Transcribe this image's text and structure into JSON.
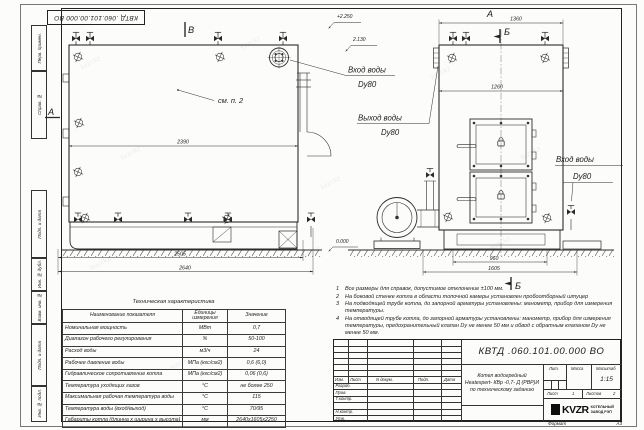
{
  "watermark": "kvzr.kz",
  "stamp_top": "КВТД .060.101.00.000 ВО",
  "margin_boxes": [
    "Перв. примен.",
    "Справ. №",
    "Подп. и дата",
    "Инв. № дубл.",
    "Взам. инв. №",
    "Подп. и дата",
    "Инв. № подл."
  ],
  "drawing": {
    "side_view": {
      "view_label_top": "В",
      "view_label_left": "А",
      "see_note": "см. п. 2",
      "dim_body": "2390",
      "dim_base": "2505",
      "dim_overall": "2640",
      "elev_top": "+2.250",
      "elev_stack": "2.130",
      "elev_zero": "0.000",
      "label_inlet": "Вход воды",
      "label_inlet_dn": "Dу80",
      "label_outlet": "Выход воды",
      "label_outlet_dn": "Dу80"
    },
    "front_view": {
      "view_label": "А",
      "dim_top": "1360",
      "dim_shell": "1260",
      "dim_base": "960",
      "dim_overall": "1605",
      "section_mark_top": "Б",
      "section_mark_bottom": "Б",
      "label_inlet": "Вход воды",
      "label_inlet_dn": "Dу80"
    }
  },
  "tech_table": {
    "title": "Техническая характеристика",
    "headers": [
      "Наименование показателя",
      "Единицы измерения",
      "Значение"
    ],
    "rows": [
      [
        "Номинальная мощность",
        "МВт",
        "0,7"
      ],
      [
        "Диапазон рабочего регулирования",
        "%",
        "50-100"
      ],
      [
        "Расход воды",
        "м3/ч",
        "24"
      ],
      [
        "Рабочее давление воды",
        "МПа (кгс/см2)",
        "0,6 (6,0)"
      ],
      [
        "Гидравлическое сопротивление котла",
        "МПа (кгс/см2)",
        "0,06 (0,6)"
      ],
      [
        "Температура уходящих газов",
        "°С",
        "не более 250"
      ],
      [
        "Максимальная рабочая температура воды",
        "°С",
        "115"
      ],
      [
        "Температура воды (вход/выход)",
        "°С",
        "70/95"
      ],
      [
        "Габариты котла (длинна х ширина х высота)",
        "мм",
        "2640х1605х2250"
      ]
    ]
  },
  "notes": [
    {
      "num": "1",
      "text": "Все размеры для справок, допустимое отклонение ±100 мм."
    },
    {
      "num": "2",
      "text": "На боковой стенке котла в области топочной камеры установлен пробоотборный штуцер"
    },
    {
      "num": "3",
      "text": "На подводящей трубе котла, до запорной арматуры установлены: манометр, прибор для измерения температуры."
    },
    {
      "num": "4",
      "text": "На отводящей трубе котла, до запорной арматуры установлены: манометр, прибор для измерения температуры, предохранительный клапан Dу не менее 50 мм и обвод с обратным клапаном Dу не менее 50 мм."
    }
  ],
  "title_block": {
    "designation": "КВТД .060.101.00.000 ВО",
    "product_line1": "Котел водогрейный",
    "product_line2": "Heatexpert- КВр -0,7- Д (РВР)И",
    "product_line3": "по техническому заданию",
    "col_headers": [
      "Изм.",
      "Лист",
      "N докум.",
      "Подп.",
      "Дата"
    ],
    "sig_rows": [
      "Разраб.",
      "Пров.",
      "Т.контр.",
      "Н.контр.",
      "Утв."
    ],
    "lit_label": "Лит.",
    "mass_label": "Масса",
    "scale_label": "Масштаб",
    "scale_value": "1:15",
    "sheet_label": "Лист",
    "sheet_num": "1",
    "sheets_label": "Листов",
    "sheets_num": "2",
    "logo": "KVZR",
    "logo_line1": "КОТЕЛЬНЫЙ",
    "logo_line2": "ЗАВОД РЭП"
  },
  "format_note": {
    "label": "Формат",
    "value": "А3"
  }
}
